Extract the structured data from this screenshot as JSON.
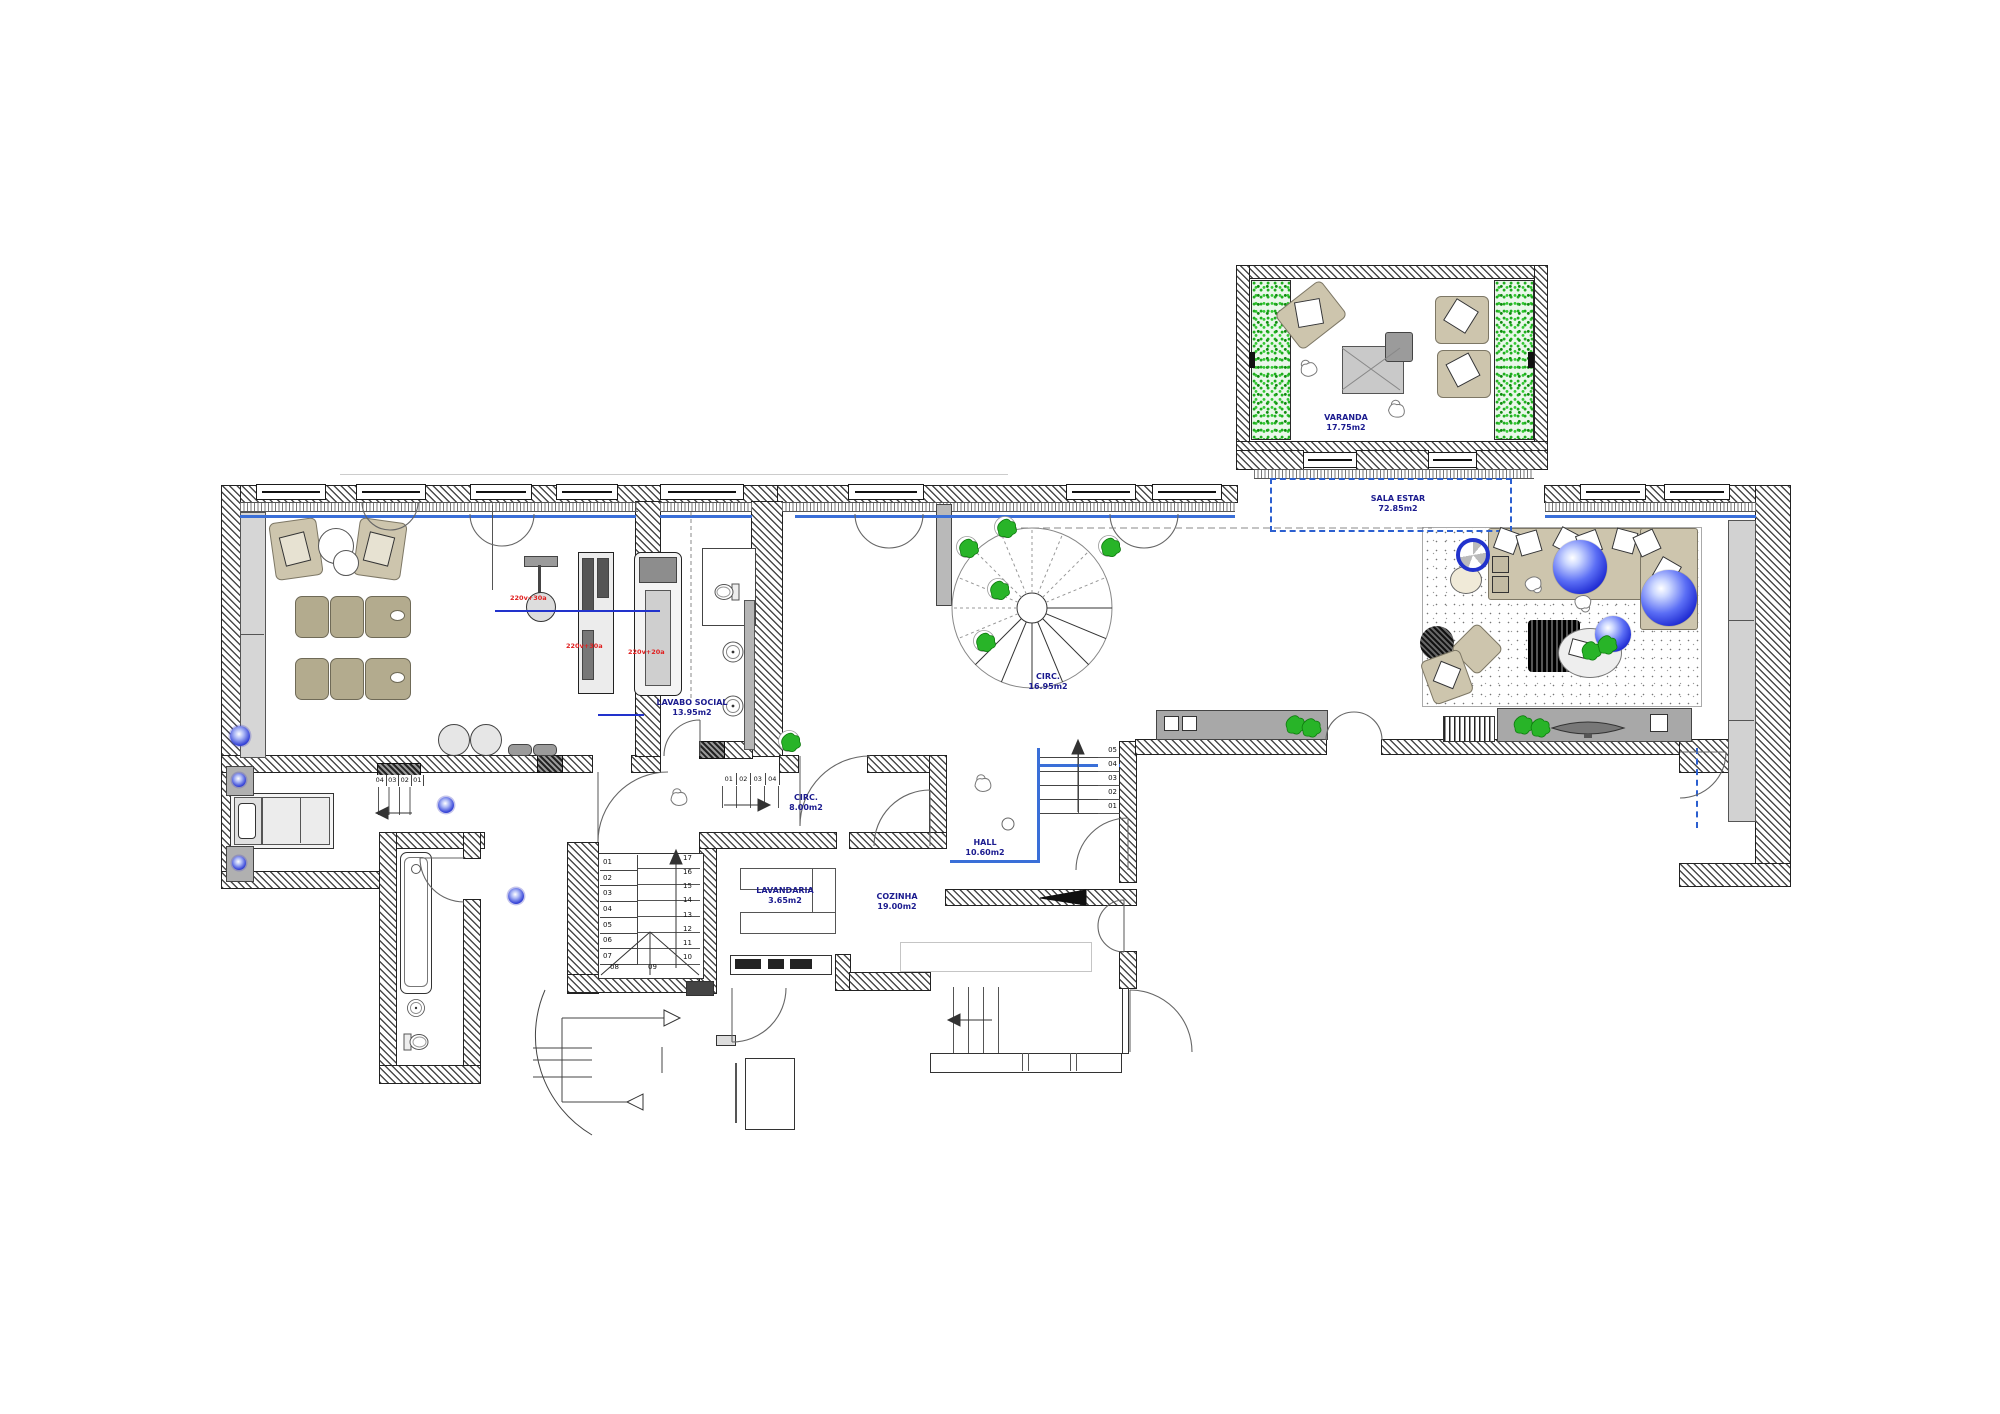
{
  "rooms": {
    "varanda": {
      "label": "VARANDA",
      "area": "17.75m2"
    },
    "sala_estar": {
      "label": "SALA ESTAR",
      "area": "72.85m2"
    },
    "circ_main": {
      "label": "CIRC.",
      "area": "16.95m2"
    },
    "lavabo_social": {
      "label": "LAVABO SOCIAL",
      "area": "13.95m2"
    },
    "circ_small": {
      "label": "CIRC.",
      "area": "8.00m2"
    },
    "hall": {
      "label": "HALL",
      "area": "10.60m2"
    },
    "lavandaria": {
      "label": "LAVANDARIA",
      "area": "3.65m2"
    },
    "cozinha": {
      "label": "COZINHA",
      "area": "19.00m2"
    }
  },
  "stairs": {
    "main_left": [
      "01",
      "02",
      "03",
      "04",
      "05",
      "06",
      "07"
    ],
    "main_right": [
      "17",
      "16",
      "15",
      "14",
      "13",
      "12",
      "11",
      "10"
    ],
    "main_winders": [
      "08",
      "09"
    ],
    "hall_steps": [
      "05",
      "04",
      "03",
      "02",
      "01"
    ],
    "corridor_steps": [
      "04",
      "03",
      "02",
      "01"
    ],
    "upper_run": [
      "01",
      "02",
      "03",
      "04"
    ]
  },
  "equipment_labels": [
    "220v+30a",
    "220v+30a",
    "220v+20a"
  ],
  "colors": {
    "room_label": "#1b1b8f",
    "glazing_blue": "#3a6fd8",
    "dashed_blue": "#2b5fd0",
    "plant_green": "#28b428",
    "sphere_blue": "#1b27d0",
    "equipment_red": "#e02020",
    "furniture_beige": "#cdc5ad",
    "wall_hatch": "#4a4a4a"
  }
}
